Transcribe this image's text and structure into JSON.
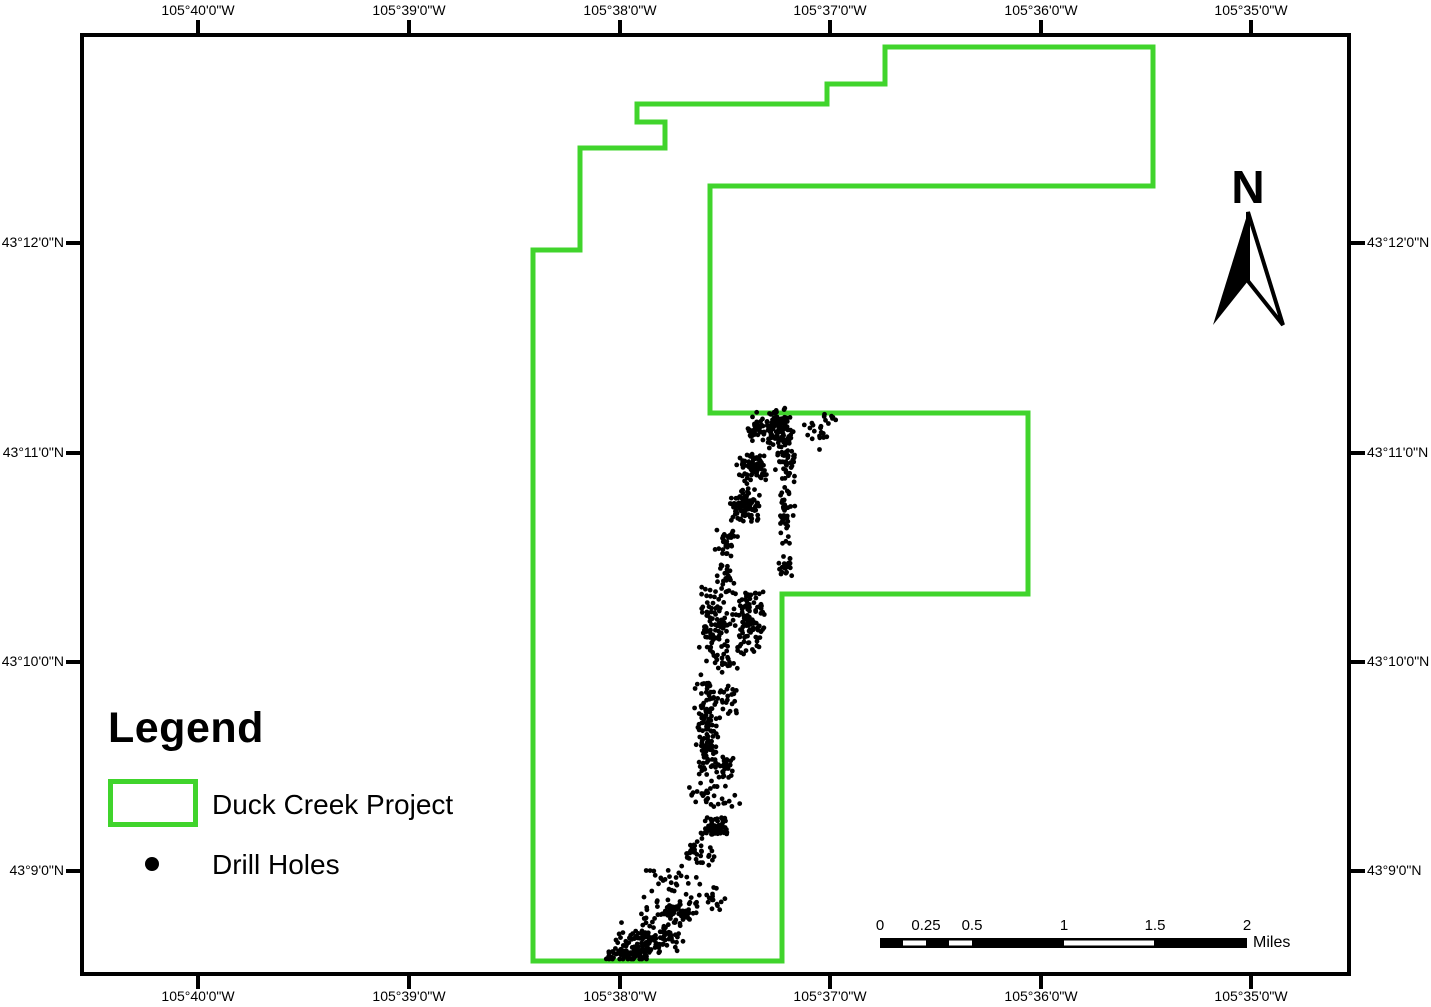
{
  "figure": {
    "kind": "project-location-map"
  },
  "graticule": {
    "top": [
      "105°40'0\"W",
      "105°39'0\"W",
      "105°38'0\"W",
      "105°37'0\"W",
      "105°36'0\"W",
      "105°35'0\"W"
    ],
    "bottom": [
      "105°40'0\"W",
      "105°39'0\"W",
      "105°38'0\"W",
      "105°37'0\"W",
      "105°36'0\"W",
      "105°35'0\"W"
    ],
    "left": [
      "43°12'0\"N",
      "43°11'0\"N",
      "43°10'0\"N",
      "43°9'0\"N"
    ],
    "right": [
      "43°12'0\"N",
      "43°11'0\"N",
      "43°10'0\"N",
      "43°9'0\"N"
    ]
  },
  "north_arrow": {
    "label": "N"
  },
  "legend": {
    "title": "Legend",
    "items": [
      {
        "label": "Duck Creek Project",
        "symbol": "polygon-outline-swatch"
      },
      {
        "label": "Drill Holes",
        "symbol": "point-marker"
      }
    ]
  },
  "scale_bar": {
    "labels": [
      "0",
      "0.25",
      "0.5",
      "1",
      "1.5",
      "2"
    ],
    "unit": "Miles"
  },
  "colors": {
    "boundary_green": "#40d42c",
    "ink": "#000000"
  },
  "boundary": {
    "name": "Duck Creek Project",
    "points": [
      [
        637,
        104
      ],
      [
        827,
        104
      ],
      [
        827,
        84
      ],
      [
        885,
        84
      ],
      [
        885,
        47
      ],
      [
        1153,
        47
      ],
      [
        1153,
        186
      ],
      [
        710,
        186
      ],
      [
        710,
        413
      ],
      [
        1028,
        413
      ],
      [
        1028,
        594
      ],
      [
        782,
        594
      ],
      [
        782,
        961
      ],
      [
        533,
        961
      ],
      [
        533,
        250
      ],
      [
        580,
        250
      ],
      [
        580,
        148
      ],
      [
        665,
        148
      ],
      [
        665,
        122
      ],
      [
        637,
        122
      ]
    ]
  },
  "drill_holes": {
    "name": "Drill Holes",
    "seed": 42,
    "dot_radius": 2.4,
    "clusters": [
      {
        "x": 778,
        "y": 428,
        "w": 30,
        "h": 34,
        "n": 95
      },
      {
        "x": 756,
        "y": 428,
        "w": 16,
        "h": 26,
        "n": 38
      },
      {
        "x": 818,
        "y": 432,
        "w": 26,
        "h": 40,
        "n": 20
      },
      {
        "x": 830,
        "y": 416,
        "w": 12,
        "h": 8,
        "n": 5
      },
      {
        "x": 786,
        "y": 462,
        "w": 18,
        "h": 56,
        "n": 60
      },
      {
        "x": 787,
        "y": 520,
        "w": 14,
        "h": 56,
        "n": 38
      },
      {
        "x": 787,
        "y": 567,
        "w": 14,
        "h": 22,
        "n": 20
      },
      {
        "x": 752,
        "y": 467,
        "w": 26,
        "h": 28,
        "n": 80
      },
      {
        "x": 745,
        "y": 505,
        "w": 28,
        "h": 30,
        "n": 85
      },
      {
        "x": 727,
        "y": 542,
        "w": 20,
        "h": 40,
        "n": 30
      },
      {
        "x": 725,
        "y": 580,
        "w": 16,
        "h": 26,
        "n": 22
      },
      {
        "x": 714,
        "y": 625,
        "w": 28,
        "h": 68,
        "n": 95
      },
      {
        "x": 750,
        "y": 620,
        "w": 32,
        "h": 58,
        "n": 105
      },
      {
        "x": 722,
        "y": 666,
        "w": 30,
        "h": 16,
        "n": 12
      },
      {
        "x": 707,
        "y": 731,
        "w": 22,
        "h": 98,
        "n": 130
      },
      {
        "x": 728,
        "y": 700,
        "w": 18,
        "h": 32,
        "n": 22
      },
      {
        "x": 725,
        "y": 768,
        "w": 18,
        "h": 20,
        "n": 30
      },
      {
        "x": 714,
        "y": 797,
        "w": 56,
        "h": 28,
        "n": 30
      },
      {
        "x": 716,
        "y": 826,
        "w": 22,
        "h": 17,
        "n": 65,
        "u": 1
      },
      {
        "x": 697,
        "y": 855,
        "w": 30,
        "h": 40,
        "n": 36
      },
      {
        "x": 668,
        "y": 884,
        "w": 58,
        "h": 32,
        "n": 24
      },
      {
        "x": 710,
        "y": 900,
        "w": 36,
        "h": 28,
        "n": 18
      },
      {
        "x": 673,
        "y": 913,
        "w": 52,
        "h": 28,
        "n": 80
      },
      {
        "x": 650,
        "y": 939,
        "w": 62,
        "h": 28,
        "n": 110
      },
      {
        "x": 628,
        "y": 955,
        "w": 46,
        "h": 13,
        "n": 60
      }
    ]
  }
}
